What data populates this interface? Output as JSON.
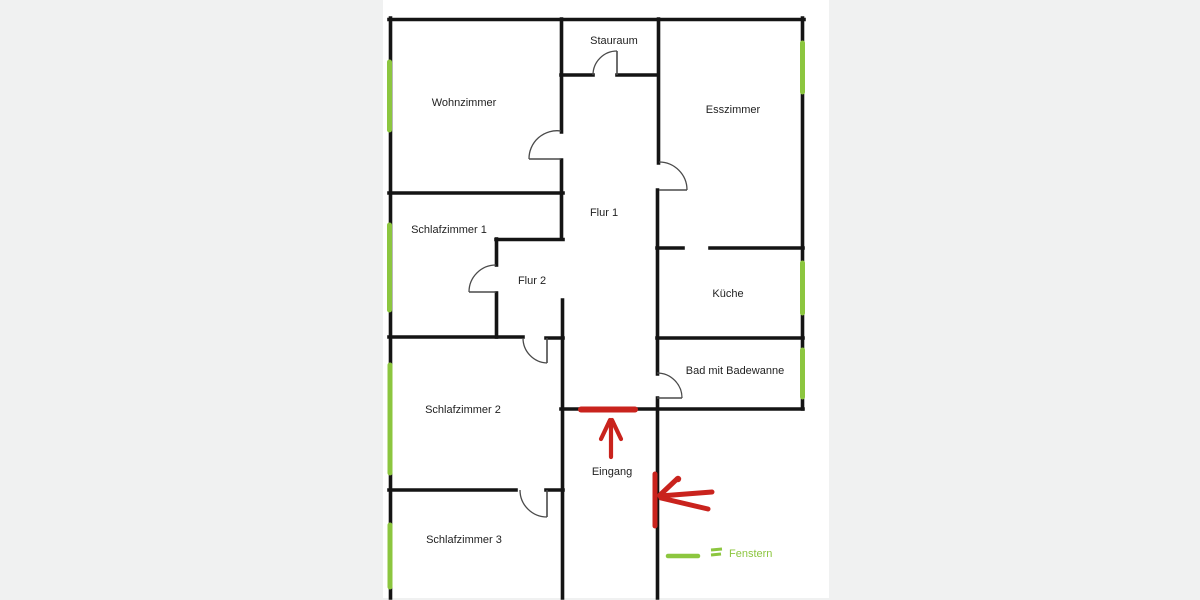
{
  "colors": {
    "background": "#f0f1f1",
    "paper": "#ffffff",
    "wall": "#141414",
    "door": "#4a4a4a",
    "window": "#8cc63f",
    "annotation": "#c9231d",
    "label": "#222222"
  },
  "paper": {
    "x": 383,
    "y": 0,
    "width": 446,
    "height": 598
  },
  "rooms": [
    {
      "label": "Wohnzimmer",
      "x": 464,
      "y": 106
    },
    {
      "label": "Stauraum",
      "x": 614,
      "y": 44
    },
    {
      "label": "Esszimmer",
      "x": 733,
      "y": 113
    },
    {
      "label": "Schlafzimmer 1",
      "x": 449,
      "y": 233
    },
    {
      "label": "Flur 1",
      "x": 604,
      "y": 216
    },
    {
      "label": "Flur 2",
      "x": 532,
      "y": 284
    },
    {
      "label": "Küche",
      "x": 728,
      "y": 297
    },
    {
      "label": "Bad mit Badewanne",
      "x": 735,
      "y": 374
    },
    {
      "label": "Schlafzimmer 2",
      "x": 463,
      "y": 413
    },
    {
      "label": "Eingang",
      "x": 612,
      "y": 475
    },
    {
      "label": "Schlafzimmer 3",
      "x": 464,
      "y": 543
    }
  ],
  "plan": {
    "wall_thickness": 3.6,
    "walls": [
      [
        389,
        19.5,
        804,
        19.5
      ],
      [
        390.5,
        18,
        390.5,
        598
      ],
      [
        802.5,
        18,
        802.5,
        409
      ],
      [
        561.5,
        19,
        561.5,
        132
      ],
      [
        561.5,
        160,
        561.5,
        239
      ],
      [
        562.5,
        300,
        562.5,
        598
      ],
      [
        658.5,
        19,
        658.5,
        163
      ],
      [
        657.5,
        190,
        657.5,
        374
      ],
      [
        657.5,
        398,
        657.5,
        598
      ],
      [
        561,
        75,
        593,
        75
      ],
      [
        617,
        75,
        658,
        75
      ],
      [
        389,
        193,
        563,
        193
      ],
      [
        496,
        239.5,
        563,
        239.5
      ],
      [
        496.5,
        239,
        496.5,
        265
      ],
      [
        496.5,
        293,
        496.5,
        337
      ],
      [
        389,
        337,
        523,
        337
      ],
      [
        546,
        338,
        563,
        338
      ],
      [
        657,
        248,
        683,
        248
      ],
      [
        710,
        248,
        803,
        248
      ],
      [
        657,
        338,
        803,
        338
      ],
      [
        561,
        409,
        803,
        409
      ],
      [
        389,
        490,
        516,
        490
      ],
      [
        546,
        490,
        563,
        490
      ]
    ],
    "window_thickness": 5,
    "windows": [
      [
        389.5,
        62,
        389.5,
        130
      ],
      [
        389.5,
        225,
        389.5,
        310
      ],
      [
        390,
        365,
        390,
        473
      ],
      [
        390,
        525,
        390,
        587
      ],
      [
        802.5,
        43,
        802.5,
        92
      ],
      [
        802.5,
        263,
        802.5,
        313
      ],
      [
        802.5,
        350,
        802.5,
        397
      ]
    ],
    "doors": [
      {
        "arc": [
          593,
          75,
          617,
          51,
          24,
          1
        ],
        "leaf": [
          617,
          51,
          617,
          75
        ]
      },
      {
        "arc": [
          561,
          131,
          529,
          159,
          28,
          0
        ],
        "leaf": [
          529,
          159,
          561,
          159
        ]
      },
      {
        "arc": [
          659,
          162,
          687,
          190,
          28,
          1
        ],
        "leaf": [
          659,
          190,
          687,
          190
        ]
      },
      {
        "arc": [
          496,
          265,
          469,
          292,
          27,
          0
        ],
        "leaf": [
          469,
          292,
          496,
          292
        ]
      },
      {
        "arc": [
          523,
          338,
          547,
          363,
          25,
          0
        ],
        "leaf": [
          547,
          338,
          547,
          363
        ]
      },
      {
        "arc": [
          657,
          373,
          682,
          398,
          25,
          1
        ],
        "leaf": [
          657,
          398,
          682,
          398
        ]
      },
      {
        "arc": [
          520,
          490,
          547,
          517,
          27,
          0
        ],
        "leaf": [
          547,
          490,
          547,
          517
        ]
      }
    ]
  },
  "annotations": {
    "entrance_door_highlight": {
      "line": [
        581,
        409.5,
        635,
        409.5
      ],
      "width": 6
    },
    "entrance_arrow": {
      "width": 4.2,
      "lines": [
        [
          611,
          457,
          611,
          422
        ],
        [
          601,
          439,
          610,
          420
        ],
        [
          621,
          439,
          612,
          420
        ]
      ]
    },
    "proposed_door_arrow": {
      "width": 5,
      "lines": [
        [
          655,
          474,
          655,
          526
        ],
        [
          712,
          492,
          660,
          496
        ],
        [
          677,
          479,
          660,
          495
        ],
        [
          661,
          498,
          708,
          509
        ]
      ],
      "dot": [
        678,
        479,
        3.2
      ]
    }
  },
  "legend": {
    "window_label": "Fenstern",
    "label_x": 729,
    "label_y": 557,
    "stroke_line": [
      668,
      556,
      698,
      556
    ],
    "stroke_width": 4.5,
    "equals_lines": [
      [
        711,
        550,
        722,
        549
      ],
      [
        711,
        555,
        721,
        554
      ]
    ],
    "equals_width": 3
  }
}
